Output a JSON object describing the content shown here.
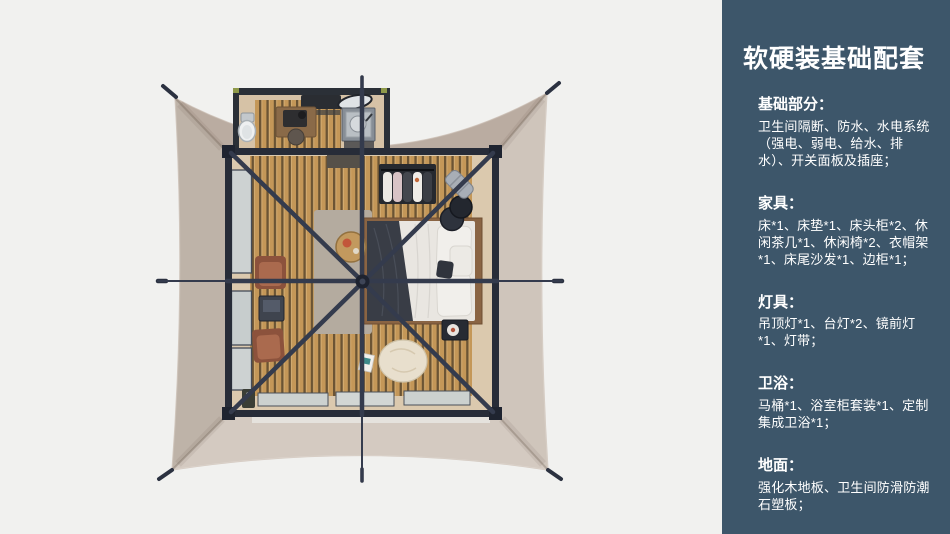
{
  "panel": {
    "title": "软硬装基础配套",
    "sections": [
      {
        "heading": "基础部分：",
        "body": "卫生间隔断、防水、水电系统（强电、弱电、给水、排水）、开关面板及插座；"
      },
      {
        "heading": "家具：",
        "body": "床*1、床垫*1、床头柜*2、休闲茶几*1、休闲椅*2、衣帽架*1、床尾沙发*1、边柜*1；"
      },
      {
        "heading": "灯具：",
        "body": "吊顶灯*1、台灯*2、镜前灯*1、灯带；"
      },
      {
        "heading": "卫浴：",
        "body": "马桶*1、浴室柜套装*1、定制集成卫浴*1；"
      },
      {
        "heading": "地面：",
        "body": "强化木地板、卫生间防滑防潮石塑板；"
      }
    ]
  },
  "colors": {
    "panel_bg": "#3D566A",
    "panel_text": "#FFFFFF",
    "page_bg": "#F1F1EF",
    "canopy": "#C8BDB3",
    "frame": "#2B3140",
    "wood_floor": "#C49758",
    "floor_base": "#DBC9AE"
  },
  "floorplan_items": [
    "tent-canopy",
    "guy-line-stakes",
    "bathroom-annex",
    "toilet",
    "bathroom-sink",
    "vanity-mirror",
    "desk",
    "desk-chair",
    "entry-mat",
    "clothes-rack",
    "suitcase",
    "round-nightstands",
    "bed",
    "dark-blanket",
    "pillows",
    "square-nightstand",
    "rug",
    "coffee-table",
    "lounge-chairs",
    "side-table",
    "bean-bag",
    "magazine",
    "left-windows",
    "bottom-windows",
    "structure-beams",
    "center-hub"
  ]
}
